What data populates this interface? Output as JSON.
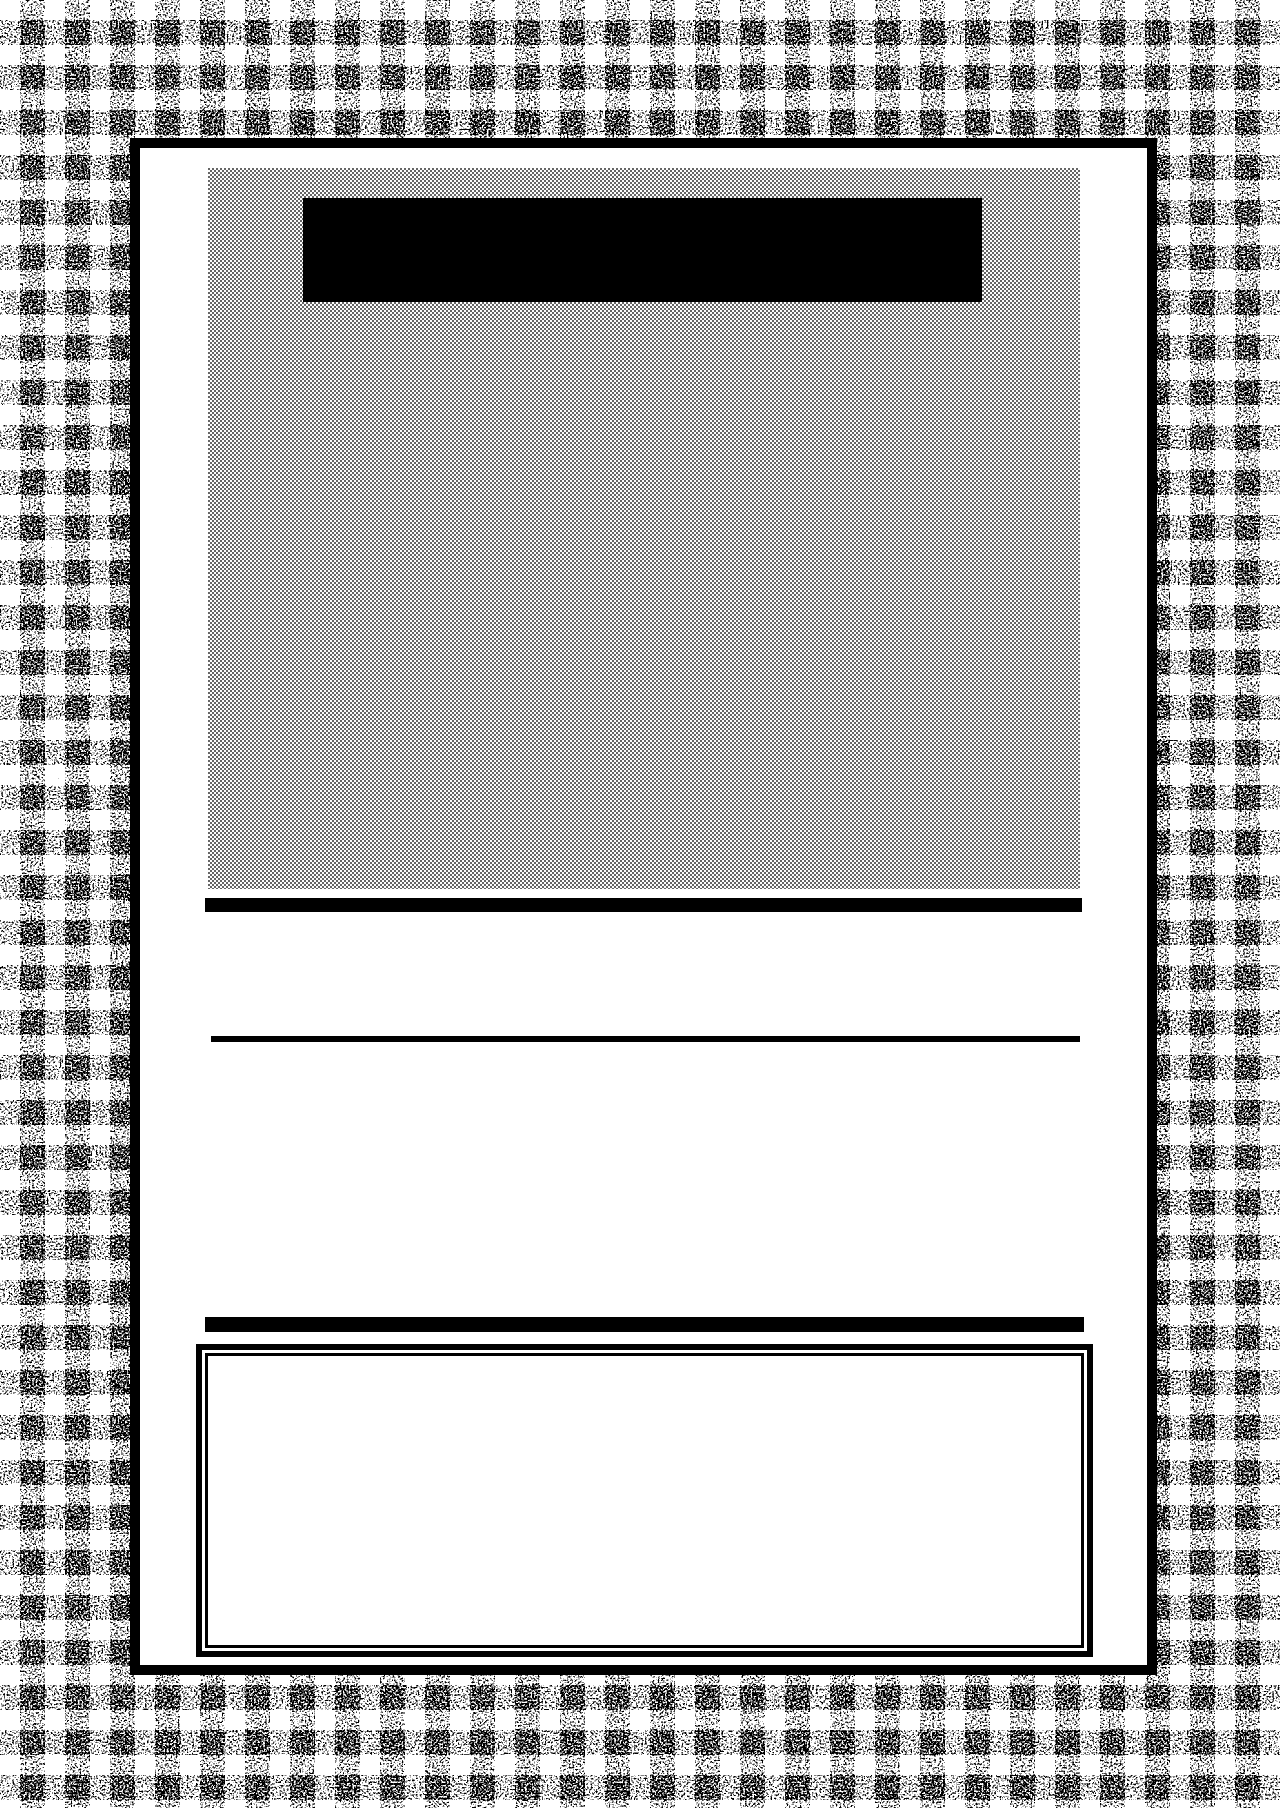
{
  "colors": {
    "ink": "#000000",
    "paper": "#ffffff",
    "halftone_dot": "#3c3c3c",
    "halftone_bg": "#fdfdfd",
    "gingham_stripe": "#555555"
  },
  "page": {
    "text_content": "",
    "notes_visible_text": "none — page contains no rendered text, only graphic blocks"
  }
}
